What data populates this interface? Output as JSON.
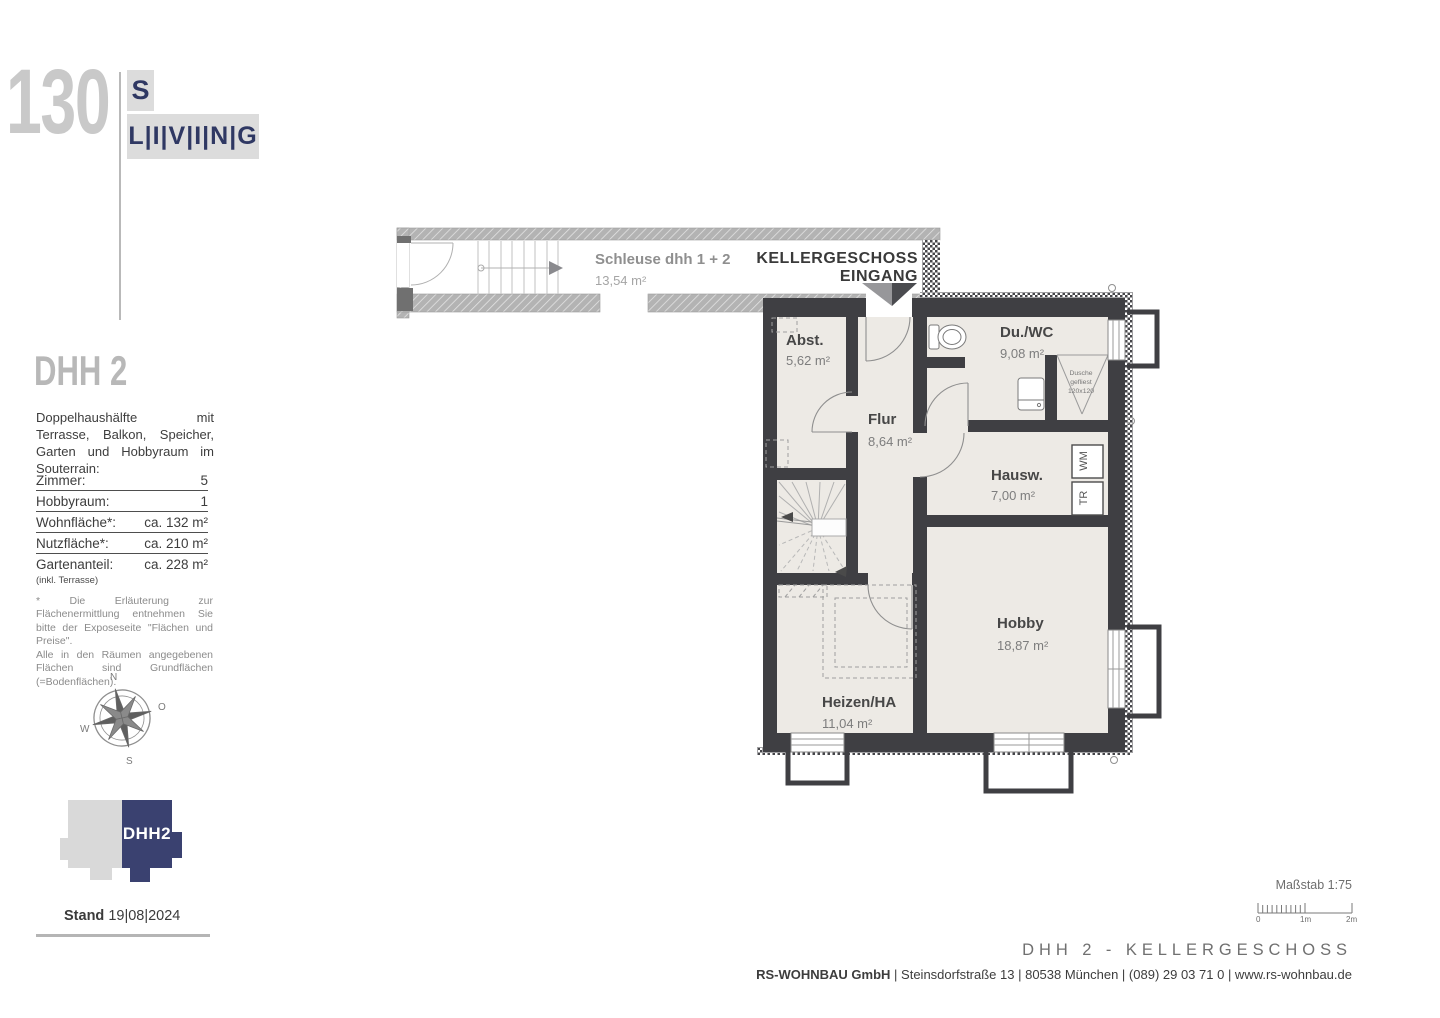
{
  "logo": {
    "number": "130",
    "s": "S",
    "living": "L|I|V|I|N|G"
  },
  "sidebar": {
    "title": "DHH 2",
    "description": "Doppelhaushälfte mit Terrasse, Balkon, Speicher, Garten und Hobbyraum im Souterrain:",
    "specs": [
      {
        "label": "Zimmer:",
        "value": "5"
      },
      {
        "label": "Hobbyraum:",
        "value": "1"
      },
      {
        "label": "Wohnfläche*:",
        "value": "ca.  132 m²"
      },
      {
        "label": "Nutzfläche*:",
        "value": "ca.  210 m²"
      },
      {
        "label": "Gartenanteil:",
        "value": "ca.  228 m²"
      }
    ],
    "spec_note": "(inkl. Terrasse)",
    "footnote1": "* Die Erläuterung zur Flächenermittlung entnehmen Sie bitte der Exposeseite \"Flächen und Preise\".",
    "footnote2": "Alle in den Räumen angegebenen Flächen sind Grundflächen (=Bodenflächen).",
    "compass": {
      "n": "N",
      "o": "O",
      "s": "S",
      "w": "W"
    },
    "house_icon_label": "DHH2",
    "stand_label": "Stand",
    "stand_date": "19|08|2024"
  },
  "plan": {
    "schleuse": {
      "name": "Schleuse dhh 1 + 2",
      "area": "13,54 m²"
    },
    "entrance": {
      "line1": "KELLERGESCHOSS",
      "line2": "EINGANG"
    },
    "rooms": [
      {
        "name": "Abst.",
        "area": "5,62 m²"
      },
      {
        "name": "Flur",
        "area": "8,64 m²"
      },
      {
        "name": "Du./WC",
        "area": "9,08 m²"
      },
      {
        "name": "Hausw.",
        "area": "7,00 m²"
      },
      {
        "name": "Hobby",
        "area": "18,87 m²"
      },
      {
        "name": "Heizen/HA",
        "area": "11,04 m²"
      }
    ],
    "fixtures": {
      "shower1": "Dusche",
      "shower2": "gefliest",
      "shower3": "120x120",
      "wm": "WM",
      "tr": "TR"
    }
  },
  "footer": {
    "scale_label": "Maßstab 1:75",
    "scale_ticks": {
      "zero": "0",
      "one": "1m",
      "two": "2m"
    },
    "plan_title": "DHH 2 - KELLERGESCHOSS",
    "company_bold": "RS-WOHNBAU GmbH",
    "company_rest": " | Steinsdorfstraße 13 |  80538 München | (089) 29 03 71 0 | www.rs-wohnbau.de"
  },
  "colors": {
    "navy": "#3a4170",
    "wall_dark": "#3f3f43",
    "wall_gray": "#b3b3b3",
    "room_fill": "#edeae5"
  }
}
